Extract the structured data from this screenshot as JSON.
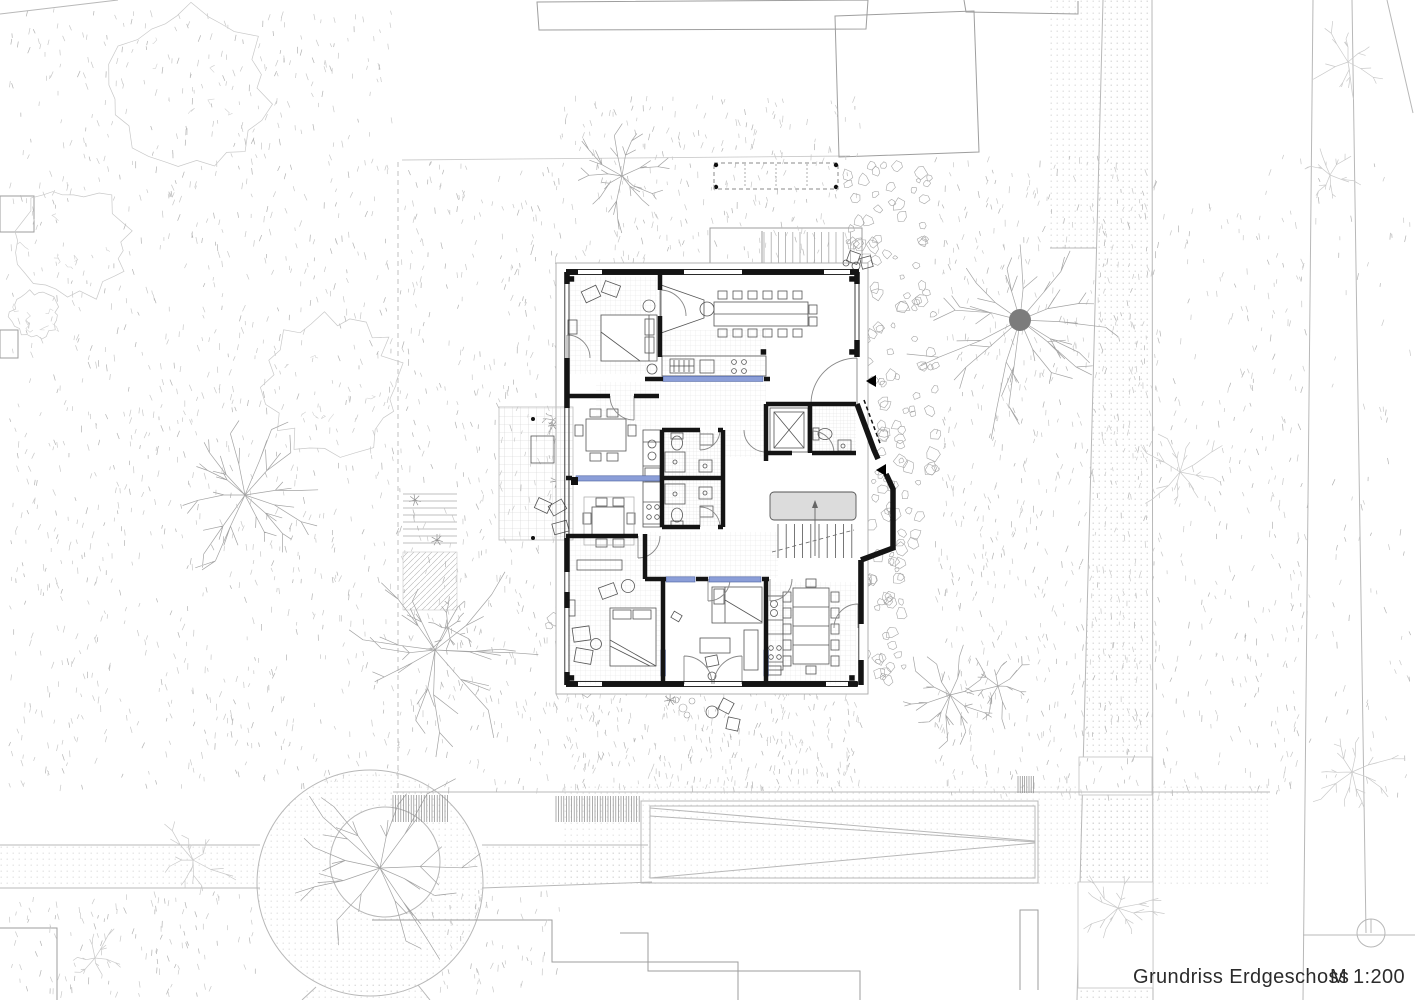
{
  "title": {
    "plan_label": "Grundriss Erdgeschoss",
    "scale_label": "M 1:200"
  },
  "colors": {
    "walls": "#141414",
    "window_accent": "#8b9ed8",
    "window_accent_edge": "#4a5f9e",
    "landscape_line": "#c2c2c2",
    "stone_line": "#a6a6a6",
    "tree_line": "#a3a3a3",
    "tree_trunk": "#7c7c7c",
    "stair_landing_fill": "#dcdcdc",
    "paper": "#ffffff",
    "caption_text": "#2b2b2b"
  }
}
